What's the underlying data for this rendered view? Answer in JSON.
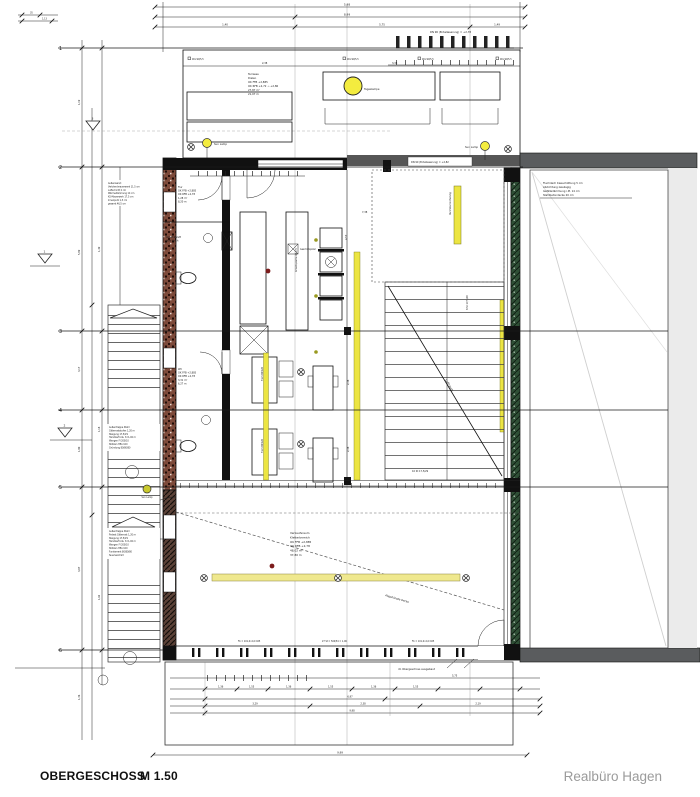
{
  "meta": {
    "floor_label": "OBERGESCHOSS",
    "scale_label": "M 1.50",
    "firm_name": "Realbüro Hagen"
  },
  "axes": {
    "rows": [
      "1",
      "2",
      "3",
      "4",
      "5",
      "6"
    ]
  },
  "markers": {
    "m1": "1",
    "m2": "2",
    "m3": "3"
  },
  "labels": {
    "sun_lamp": "Sun Lamp",
    "luftraum": "Luftraum",
    "ceiling": "Abgehängte Decke"
  },
  "terrace": {
    "skylight": "Tageslampe",
    "drain_top": "DN 90 (Entwässerung) = +2,78",
    "drain_bottom": "DN 90 (Entwässerung) = +2,82",
    "post": "90×90/5,5",
    "info": [
      "Terrasse",
      "Dielen",
      "OK FFB +2,885",
      "OK RFB +2,72 → +2,86",
      "27,87 m²",
      "21,07 m"
    ]
  },
  "rooms": {
    "flur": [
      "Flur",
      "OK FFB +2,885",
      "OK RFB +2,78",
      "1,28 m²",
      "8,20 m"
    ],
    "wc": [
      "WC",
      "OK FFB +2,885",
      "OK RFB +2,78",
      "3,31 m²",
      "6,27 m"
    ],
    "vent": [
      "Abluft/Zuluft",
      "über Dach"
    ],
    "verkaufsraum": [
      "Verkaufsraum",
      "Kletterbereich",
      "OK FFB +2,885",
      "OK RFB +2,78",
      "48,02 m²",
      "37,80 m"
    ]
  },
  "kitchen": {
    "counter": "Arbeitsplatte 60 cm",
    "dishwasher": "Geschirrspüler"
  },
  "furniture": {
    "table": "Tisch 80/120"
  },
  "stairs": {
    "upper": "8 St 17,5/29",
    "lower": "10 St 17,5/29",
    "guard": "Durchsturzsicherung"
  },
  "roof": {
    "info": [
      "Flachdach Kiesschüttung 5 cm",
      "Abdichtung zweilagig",
      "Gefälledämmung i.M. 14 cm",
      "Stahlbetondecke 20 cm"
    ]
  },
  "wall_spec": [
    "Außenwand:",
    "Verblendmauerwerk 11,5 cm",
    "Luftschicht 2 cm",
    "Wärmedämmung 14 cm",
    "KS-Mauerwerk 17,5 cm",
    "Innenputz 1,5 cm",
    "gesamt 46,5 cm"
  ],
  "ext_stairs": {
    "upper": [
      "Außentreppe Stahl",
      "Gitterroststufen 1,20 m",
      "Steigung 17,5/29",
      "Handlauf bds. h=1,00 m",
      "Wangen Fl 200/10",
      "Stützen HEA 100",
      "Gründung 80/80/80"
    ],
    "lower": [
      "Außentreppe Stahl",
      "Podest Gitterrost 1,20 m",
      "Steigung 17,5/29",
      "Handlauf bds. h=1,00 m",
      "Wangen Fl 200/10",
      "Stützen HEA 100",
      "Fundament 80/80/80",
      "feuerverzinkt"
    ]
  },
  "notes": {
    "converted": "im Obergeschoss ausgebaut",
    "fb_left": "Fb = 101,0×0,0 025",
    "steps": "27 St = 500/54 = 1,06",
    "fb_right": "Fb = 101,0×0,0 025"
  },
  "dims": {
    "top": {
      "r1": "5,98",
      "r2": "8,99",
      "r3a": "1,40",
      "r3b": "5,75",
      "r3c": "1,49",
      "t1": "2,38",
      "t2": "3,38",
      "t3": "35",
      "t4": "1,13"
    },
    "bottom": {
      "b1": "1,36",
      "b2": "1,55",
      "b3": "1,36",
      "b4": "1,55",
      "b5": "1,36",
      "b6": "1,55",
      "c1": "6,97",
      "d1": "3,29",
      "d2": "2,38",
      "d3": "2,19",
      "e1": "9,98",
      "f1": "9,99",
      "s1": "5,75"
    },
    "left": {
      "l1": "1,19",
      "l2": "5,99",
      "l3": "3,17",
      "l4": "1,80",
      "l5": "3,07",
      "l6": "1,36",
      "m1": "1,49",
      "m2": "1,18",
      "m3": "1,62"
    },
    "inner": {
      "i1": "7,38",
      "i2": "4,57",
      "i3": "2,38",
      "i4": "2,38"
    }
  },
  "colors": {
    "brick": "#7d4a3a",
    "green_wall": "#2f4f36",
    "gray_wall": "#5a5c5e",
    "yellow": "#ece542",
    "pale_yellow": "#efe88e",
    "sun_yellow": "#f3ec3f",
    "red_dot": "#7c1c1c"
  }
}
